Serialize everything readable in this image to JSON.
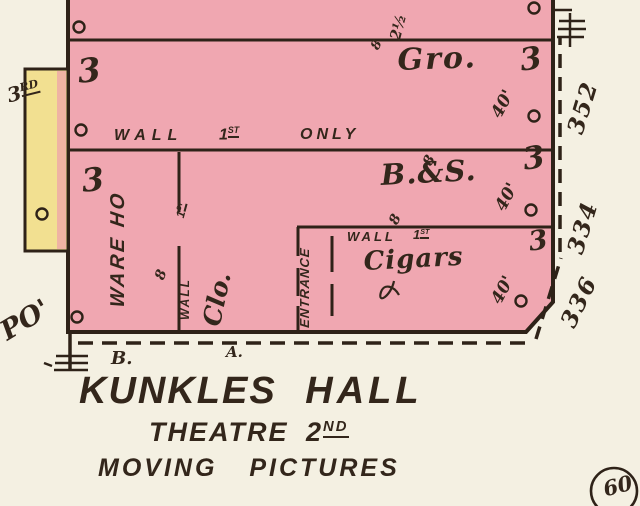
{
  "colors": {
    "building_pink": "#f0a7b1",
    "adjacent_yellow": "#f2e091",
    "ink": "#33261b",
    "paper": "#f4f0e2"
  },
  "streets": {
    "third_num": "3",
    "third_sup": "RD",
    "po": "PO'"
  },
  "notes": {
    "top_height": "2½",
    "top_eight": "8"
  },
  "walls": {
    "first_only": {
      "wall": "WALL",
      "num": "1",
      "sup": "ST",
      "only": "ONLY"
    },
    "first": {
      "wall": "WALL",
      "num": "1",
      "sup": "ST"
    }
  },
  "rooms": {
    "gro": {
      "label": "Gro.",
      "floors_left": "3",
      "floors_right": "3",
      "depth": "40'"
    },
    "warehouse": {
      "label": "WARE HO",
      "floors": "3",
      "wall": "WALL",
      "first_num": "1",
      "first_sup": "ST",
      "height": "8"
    },
    "clo": {
      "label": "Clo."
    },
    "bs": {
      "label": "B.&S.",
      "floors": "3",
      "depth": "40'",
      "height_top": "8",
      "height_bottom": "8"
    },
    "cigars": {
      "label": "Cigars",
      "floors": "3",
      "depth": "40'"
    },
    "entrance": {
      "label": "ENTRANCE"
    }
  },
  "addresses": {
    "a352": "352",
    "a334": "334",
    "a336": "336"
  },
  "lots": {
    "b": "B.",
    "a": "A."
  },
  "caption": {
    "name1": "KUNKLES",
    "name2": "HALL",
    "sub1_word": "THEATRE",
    "sub1_num": "2",
    "sub1_sup": "ND",
    "sub2_word1": "MOVING",
    "sub2_word2": "PICTURES"
  },
  "badge": {
    "number": "60"
  }
}
